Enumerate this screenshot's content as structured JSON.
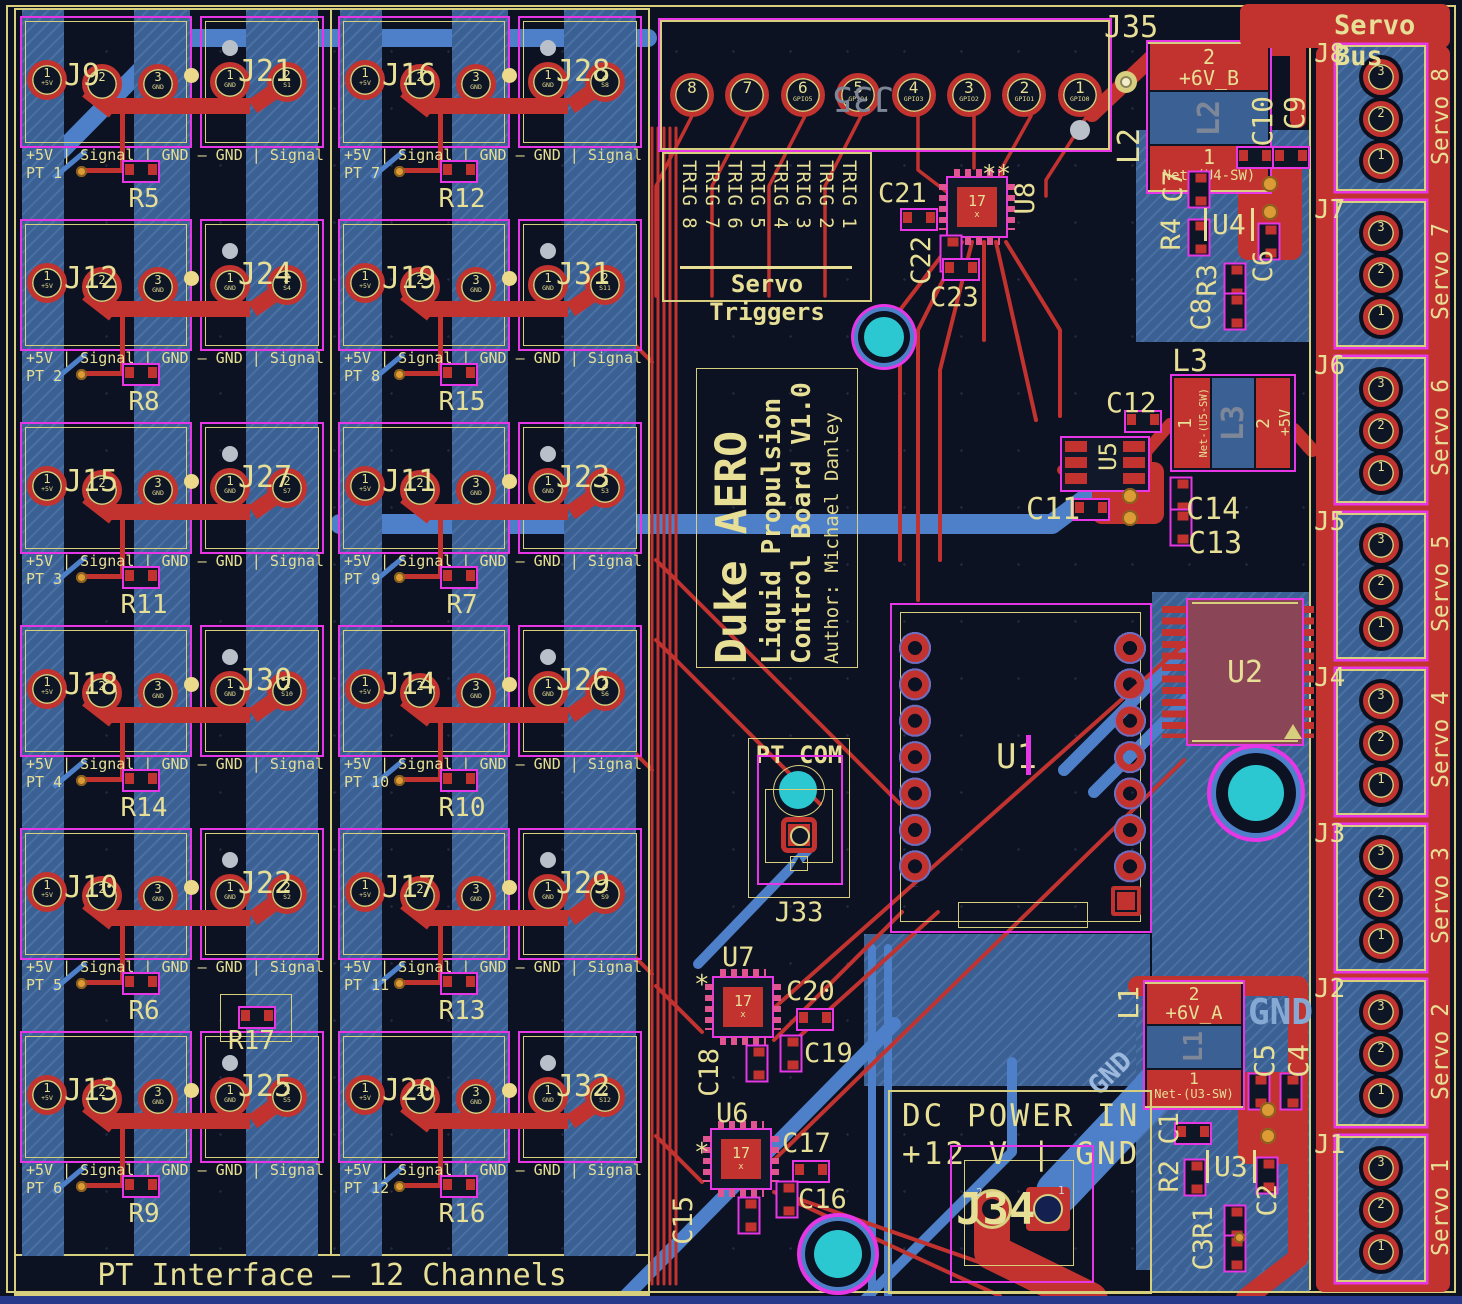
{
  "colors": {
    "silk": "#e7df95",
    "copper_red": "#c23330",
    "copper_blue": "#4d80c9",
    "zone_blue": "#3a6094",
    "courtyard_magenta": "#e636e6",
    "hole_cyan": "#2bc8d2",
    "background": "#0c1222"
  },
  "pt": {
    "title": "PT Interface — 12 Channels",
    "row_label": "+5V | Signal | GND – GND | Signal",
    "pads": {
      "p1": "1",
      "p2": "2",
      "p3": "3",
      "p1_net": "+5V",
      "p3_net": "GND",
      "b1": "1",
      "b1_net": "GND",
      "b2": "2"
    },
    "extra_res": "R17",
    "col0": [
      {
        "pt": "PT 1",
        "jl": "J9",
        "jr": "J21",
        "sig": "S1",
        "res": "R5"
      },
      {
        "pt": "PT 2",
        "jl": "J12",
        "jr": "J24",
        "sig": "S4",
        "res": "R8"
      },
      {
        "pt": "PT 3",
        "jl": "J15",
        "jr": "J27",
        "sig": "S7",
        "res": "R11"
      },
      {
        "pt": "PT 4",
        "jl": "J18",
        "jr": "J30",
        "sig": "S10",
        "res": "R14"
      },
      {
        "pt": "PT 5",
        "jl": "J10",
        "jr": "J22",
        "sig": "S2",
        "res": "R6"
      },
      {
        "pt": "PT 6",
        "jl": "J13",
        "jr": "J25",
        "sig": "S5",
        "res": "R9"
      }
    ],
    "col1": [
      {
        "pt": "PT 7",
        "jl": "J16",
        "jr": "J28",
        "sig": "S8",
        "res": "R12"
      },
      {
        "pt": "PT 8",
        "jl": "J19",
        "jr": "J31",
        "sig": "S11",
        "res": "R15"
      },
      {
        "pt": "PT 9",
        "jl": "J11",
        "jr": "J23",
        "sig": "S3",
        "res": "R7"
      },
      {
        "pt": "PT 10",
        "jl": "J14",
        "jr": "J26",
        "sig": "S6",
        "res": "R10"
      },
      {
        "pt": "PT 11",
        "jl": "J17",
        "jr": "J29",
        "sig": "S9",
        "res": "R13"
      },
      {
        "pt": "PT 12",
        "jl": "J20",
        "jr": "J32",
        "sig": "S12",
        "res": "R16"
      }
    ]
  },
  "servo_triggers": {
    "title": "Servo Triggers",
    "j_top": "J35",
    "j_mirror": "J35",
    "pins": [
      {
        "n": "8",
        "gpio": ""
      },
      {
        "n": "7",
        "gpio": ""
      },
      {
        "n": "6",
        "gpio": "GPIO5"
      },
      {
        "n": "5",
        "gpio": "GPIO4"
      },
      {
        "n": "4",
        "gpio": "GPIO3"
      },
      {
        "n": "3",
        "gpio": "GPIO2"
      },
      {
        "n": "2",
        "gpio": "GPIO1"
      },
      {
        "n": "1",
        "gpio": "GPIO0"
      }
    ],
    "trigs": [
      "TRIG 8",
      "TRIG 7",
      "TRIG 6",
      "TRIG 5",
      "TRIG 4",
      "TRIG 3",
      "TRIG 2",
      "TRIG 1"
    ]
  },
  "title_block": {
    "l1": "Duke AERO",
    "l2": "Liquid Propulsion",
    "l3": "Control Board V1.0",
    "l4": "Author: Michael Danley"
  },
  "pt_com": {
    "title": "PT COM",
    "ref": "J33"
  },
  "dc_power": {
    "l1": "DC POWER IN",
    "l2": "+12 V | GND",
    "ref": "J34",
    "p2": "2",
    "p1": "1",
    "gnd": "GND"
  },
  "servo_bus": {
    "title": "Servo Bus",
    "pins": [
      "3",
      "2",
      "1"
    ],
    "connectors": [
      {
        "ref": "J8",
        "name": "Servo 8"
      },
      {
        "ref": "J7",
        "name": "Servo 7"
      },
      {
        "ref": "J6",
        "name": "Servo 6"
      },
      {
        "ref": "J5",
        "name": "Servo 5"
      },
      {
        "ref": "J4",
        "name": "Servo 4"
      },
      {
        "ref": "J3",
        "name": "Servo 3"
      },
      {
        "ref": "J2",
        "name": "Servo 2"
      },
      {
        "ref": "J1",
        "name": "Servo 1"
      }
    ]
  },
  "center": {
    "u1": "U1",
    "u2": "U2"
  },
  "u8": {
    "ref": "U8",
    "chip": "17",
    "chip_sub": "x",
    "marks": "**",
    "c21": "C21",
    "c22": "C22",
    "c23": "C23"
  },
  "u7": {
    "ref": "U7",
    "chip": "17",
    "chip_sub": "x",
    "marks": "*",
    "c18": "C18",
    "c19": "C19",
    "c20": "C20"
  },
  "u6": {
    "ref": "U6",
    "chip": "17",
    "chip_sub": "x",
    "marks": "*",
    "c15": "C15",
    "c16": "C16",
    "c17": "C17"
  },
  "u5": {
    "ref": "U5",
    "l3": "L3",
    "l3_core": "L3",
    "l3_p1": "1",
    "l3_p1_net": "Net-(U5-SW)",
    "l3_p2": "2",
    "l3_p2_net": "+5V",
    "c11": "C11",
    "c12": "C12",
    "c13": "C13",
    "c14": "C14"
  },
  "u4": {
    "ref": "U4",
    "l2": "L2",
    "l2_core": "L2",
    "l2_p2": "2",
    "l2_p2_net": "+6V_B",
    "l2_p1": "1",
    "l2_p1_net": "Net-(U4-SW)",
    "c6": "C6",
    "c7": "C7",
    "c8": "C8",
    "c9": "C9",
    "c10": "C10",
    "r3": "R3",
    "r4": "R4"
  },
  "u3": {
    "ref": "U3",
    "l1": "L1",
    "l1_core": "L1",
    "l1_p2": "2",
    "l1_p2_net": "+6V_A",
    "l1_p1": "1",
    "l1_p1_net": "Net-(U3-SW)",
    "c1": "C1",
    "c2": "C2",
    "c3": "C3",
    "c4": "C4",
    "c5": "C5",
    "r1": "R1",
    "r2": "R2",
    "gnd_zone": "GND",
    "gnd_trace": "GND"
  }
}
